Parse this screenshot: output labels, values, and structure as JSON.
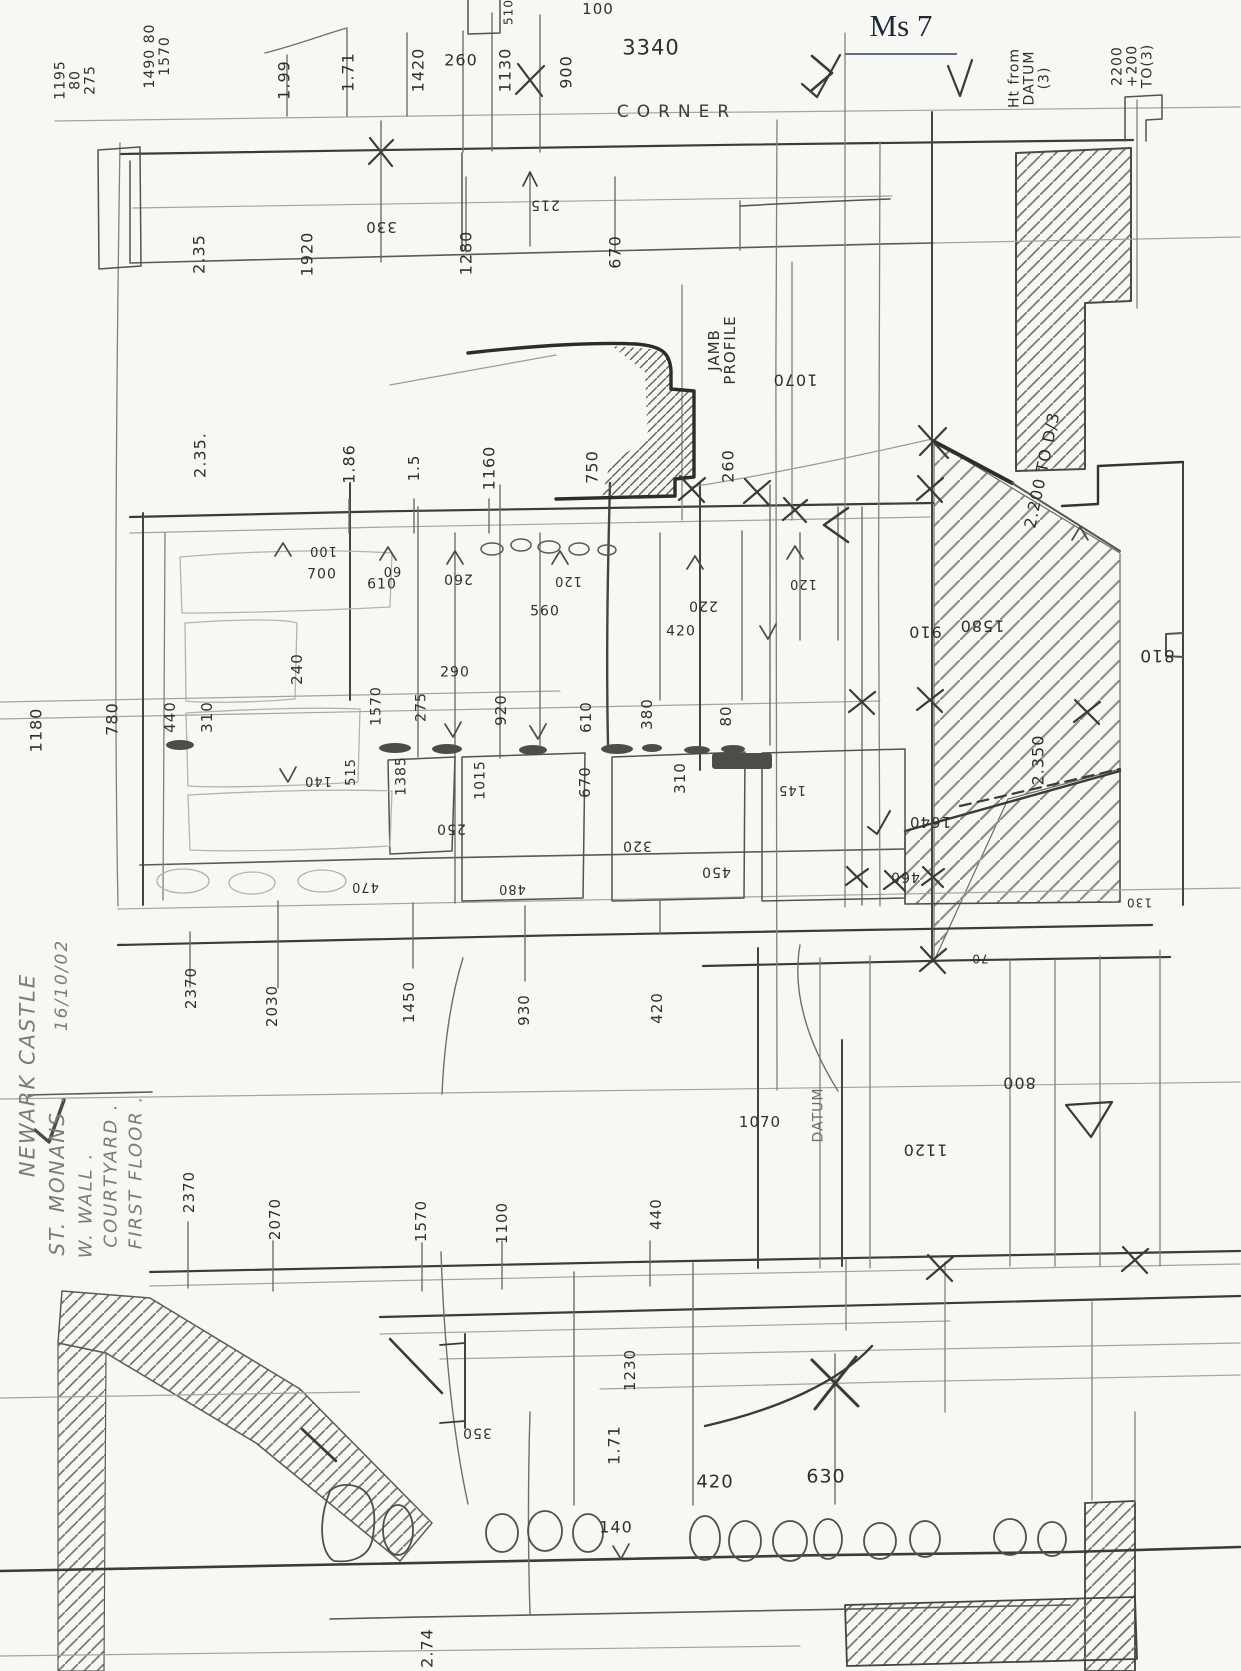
{
  "header": {
    "sheet_label": "Ms 7"
  },
  "palette": {
    "paper": "#f7f7f4",
    "pencil_dark": "#3b3b39",
    "pencil_faint": "#9a9a96",
    "title_ink": "#20293a"
  },
  "annotations": [
    {
      "t": "1195\n80\n275",
      "x": 76,
      "y": 80,
      "r": -90,
      "s": 14
    },
    {
      "t": "1490 80\n1570",
      "x": 158,
      "y": 56,
      "r": -90,
      "s": 14
    },
    {
      "t": "1.99",
      "x": 284,
      "y": 80,
      "r": -90,
      "s": 16
    },
    {
      "t": "1.71",
      "x": 348,
      "y": 72,
      "r": -90,
      "s": 16
    },
    {
      "t": "1420",
      "x": 418,
      "y": 70,
      "r": -90,
      "s": 16
    },
    {
      "t": "260",
      "x": 461,
      "y": 60,
      "r": 0,
      "s": 16
    },
    {
      "t": "1130",
      "x": 505,
      "y": 70,
      "r": -90,
      "s": 16
    },
    {
      "t": "900",
      "x": 566,
      "y": 72,
      "r": -90,
      "s": 16
    },
    {
      "t": "100",
      "x": 598,
      "y": 9,
      "r": 0,
      "s": 15
    },
    {
      "t": "510",
      "x": 509,
      "y": 12,
      "r": -90,
      "s": 12
    },
    {
      "t": "3340",
      "x": 651,
      "y": 48,
      "r": 0,
      "s": 21
    },
    {
      "t": "CORNER",
      "x": 677,
      "y": 112,
      "r": 0,
      "s": 17,
      "c": "spread",
      "n": "corner-label"
    },
    {
      "t": "Ht from\nDATUM\n(3)",
      "x": 1030,
      "y": 78,
      "r": -90,
      "s": 14
    },
    {
      "t": "2200\n+200\nTO(3)",
      "x": 1133,
      "y": 66,
      "r": -90,
      "s": 14
    },
    {
      "t": "2.35",
      "x": 199,
      "y": 254,
      "r": -90,
      "s": 16
    },
    {
      "t": "1920",
      "x": 307,
      "y": 254,
      "r": -90,
      "s": 16
    },
    {
      "t": "330",
      "x": 381,
      "y": 227,
      "r": 180,
      "s": 15
    },
    {
      "t": "215",
      "x": 545,
      "y": 204,
      "r": 180,
      "s": 14
    },
    {
      "t": "1280",
      "x": 466,
      "y": 253,
      "r": -90,
      "s": 16
    },
    {
      "t": "670",
      "x": 615,
      "y": 252,
      "r": -90,
      "s": 16
    },
    {
      "t": "JAMB\nPROFILE",
      "x": 722,
      "y": 350,
      "r": -90,
      "s": 15,
      "n": "jamb-profile-label"
    },
    {
      "t": "1070",
      "x": 795,
      "y": 380,
      "r": 180,
      "s": 16
    },
    {
      "t": "2.35.",
      "x": 200,
      "y": 455,
      "r": -90,
      "s": 16
    },
    {
      "t": "1.86",
      "x": 349,
      "y": 464,
      "r": -90,
      "s": 16
    },
    {
      "t": "1.5",
      "x": 414,
      "y": 468,
      "r": -90,
      "s": 15
    },
    {
      "t": "1160",
      "x": 489,
      "y": 468,
      "r": -90,
      "s": 16
    },
    {
      "t": "750",
      "x": 592,
      "y": 467,
      "r": -90,
      "s": 16
    },
    {
      "t": "260",
      "x": 728,
      "y": 466,
      "r": -90,
      "s": 16
    },
    {
      "t": "2.200 TO D/3",
      "x": 1042,
      "y": 470,
      "r": -78,
      "s": 16
    },
    {
      "t": "100",
      "x": 323,
      "y": 550,
      "r": 180,
      "s": 13
    },
    {
      "t": "700",
      "x": 322,
      "y": 575,
      "r": 0,
      "s": 14
    },
    {
      "t": "60",
      "x": 392,
      "y": 570,
      "r": 180,
      "s": 13
    },
    {
      "t": "610",
      "x": 382,
      "y": 585,
      "r": 0,
      "s": 14
    },
    {
      "t": "260",
      "x": 458,
      "y": 578,
      "r": 180,
      "s": 14
    },
    {
      "t": "120",
      "x": 568,
      "y": 580,
      "r": 180,
      "s": 13
    },
    {
      "t": "560",
      "x": 545,
      "y": 612,
      "r": 0,
      "s": 14
    },
    {
      "t": "220",
      "x": 703,
      "y": 605,
      "r": 180,
      "s": 14
    },
    {
      "t": "120",
      "x": 803,
      "y": 583,
      "r": 180,
      "s": 13
    },
    {
      "t": "420",
      "x": 681,
      "y": 632,
      "r": 0,
      "s": 14
    },
    {
      "t": "910",
      "x": 925,
      "y": 632,
      "r": 180,
      "s": 16
    },
    {
      "t": "1580",
      "x": 982,
      "y": 626,
      "r": 180,
      "s": 16
    },
    {
      "t": "810",
      "x": 1157,
      "y": 655,
      "r": 180,
      "s": 17
    },
    {
      "t": "240",
      "x": 297,
      "y": 669,
      "r": -90,
      "s": 15
    },
    {
      "t": "1180",
      "x": 36,
      "y": 730,
      "r": -90,
      "s": 16
    },
    {
      "t": "780",
      "x": 112,
      "y": 719,
      "r": -90,
      "s": 16
    },
    {
      "t": "440",
      "x": 170,
      "y": 717,
      "r": -90,
      "s": 15
    },
    {
      "t": "310",
      "x": 207,
      "y": 717,
      "r": -90,
      "s": 15
    },
    {
      "t": "140",
      "x": 318,
      "y": 780,
      "r": 180,
      "s": 13
    },
    {
      "t": "515",
      "x": 352,
      "y": 772,
      "r": -90,
      "s": 13
    },
    {
      "t": "1570",
      "x": 377,
      "y": 706,
      "r": -90,
      "s": 14
    },
    {
      "t": "275",
      "x": 422,
      "y": 707,
      "r": -90,
      "s": 14
    },
    {
      "t": "290",
      "x": 455,
      "y": 673,
      "r": 0,
      "s": 14
    },
    {
      "t": "920",
      "x": 501,
      "y": 710,
      "r": -90,
      "s": 15
    },
    {
      "t": "610",
      "x": 586,
      "y": 717,
      "r": -90,
      "s": 15
    },
    {
      "t": "380",
      "x": 647,
      "y": 714,
      "r": -90,
      "s": 15
    },
    {
      "t": "80",
      "x": 726,
      "y": 716,
      "r": -90,
      "s": 15
    },
    {
      "t": "1385",
      "x": 402,
      "y": 776,
      "r": -90,
      "s": 14
    },
    {
      "t": "1015",
      "x": 481,
      "y": 780,
      "r": -90,
      "s": 14
    },
    {
      "t": "670",
      "x": 585,
      "y": 782,
      "r": -90,
      "s": 15
    },
    {
      "t": "310",
      "x": 680,
      "y": 778,
      "r": -90,
      "s": 15
    },
    {
      "t": "145",
      "x": 792,
      "y": 789,
      "r": 180,
      "s": 13
    },
    {
      "t": "250",
      "x": 451,
      "y": 828,
      "r": 180,
      "s": 14
    },
    {
      "t": "320",
      "x": 637,
      "y": 845,
      "r": 180,
      "s": 14
    },
    {
      "t": "450",
      "x": 716,
      "y": 871,
      "r": 180,
      "s": 14
    },
    {
      "t": "470",
      "x": 365,
      "y": 886,
      "r": 180,
      "s": 13
    },
    {
      "t": "480",
      "x": 512,
      "y": 888,
      "r": 180,
      "s": 13
    },
    {
      "t": "460",
      "x": 905,
      "y": 876,
      "r": 180,
      "s": 14
    },
    {
      "t": "1640",
      "x": 930,
      "y": 822,
      "r": 180,
      "s": 15
    },
    {
      "t": "2.350",
      "x": 1038,
      "y": 760,
      "r": -90,
      "s": 16
    },
    {
      "t": "130",
      "x": 1139,
      "y": 902,
      "r": 180,
      "s": 12
    },
    {
      "t": "70",
      "x": 980,
      "y": 958,
      "r": 180,
      "s": 12
    },
    {
      "t": "2370",
      "x": 191,
      "y": 988,
      "r": -90,
      "s": 15
    },
    {
      "t": "2030",
      "x": 272,
      "y": 1006,
      "r": -90,
      "s": 15
    },
    {
      "t": "1450",
      "x": 409,
      "y": 1002,
      "r": -90,
      "s": 15
    },
    {
      "t": "930",
      "x": 524,
      "y": 1010,
      "r": -90,
      "s": 15
    },
    {
      "t": "420",
      "x": 657,
      "y": 1008,
      "r": -90,
      "s": 15
    },
    {
      "t": "1070",
      "x": 760,
      "y": 1122,
      "r": 0,
      "s": 15
    },
    {
      "t": "DATUM",
      "x": 819,
      "y": 1115,
      "r": -90,
      "s": 14,
      "c": "faint",
      "n": "datum-label"
    },
    {
      "t": "800",
      "x": 1019,
      "y": 1083,
      "r": 180,
      "s": 16
    },
    {
      "t": "1120",
      "x": 925,
      "y": 1150,
      "r": 180,
      "s": 16
    },
    {
      "t": "2370",
      "x": 189,
      "y": 1192,
      "r": -90,
      "s": 15
    },
    {
      "t": "2070",
      "x": 275,
      "y": 1219,
      "r": -90,
      "s": 15
    },
    {
      "t": "1570",
      "x": 421,
      "y": 1221,
      "r": -90,
      "s": 15
    },
    {
      "t": "1100",
      "x": 502,
      "y": 1223,
      "r": -90,
      "s": 15
    },
    {
      "t": "440",
      "x": 656,
      "y": 1214,
      "r": -90,
      "s": 15
    },
    {
      "t": "1230",
      "x": 630,
      "y": 1370,
      "r": -90,
      "s": 15
    },
    {
      "t": "350",
      "x": 477,
      "y": 1432,
      "r": 180,
      "s": 14
    },
    {
      "t": "1.71",
      "x": 614,
      "y": 1445,
      "r": -90,
      "s": 16
    },
    {
      "t": "420",
      "x": 715,
      "y": 1482,
      "r": 0,
      "s": 18
    },
    {
      "t": "630",
      "x": 826,
      "y": 1477,
      "r": 0,
      "s": 19
    },
    {
      "t": "140",
      "x": 616,
      "y": 1527,
      "r": 0,
      "s": 16
    },
    {
      "t": "2.74",
      "x": 427,
      "y": 1648,
      "r": -90,
      "s": 16
    },
    {
      "t": "NEWARK CASTLE",
      "x": 28,
      "y": 1075,
      "r": -90,
      "s": 21,
      "c": "pencil",
      "n": "title-line"
    },
    {
      "t": "16/10/02",
      "x": 62,
      "y": 985,
      "r": -90,
      "s": 17,
      "c": "pencil",
      "n": "survey-date"
    },
    {
      "t": "ST. MONANS .",
      "x": 58,
      "y": 1175,
      "r": -90,
      "s": 20,
      "c": "pencil",
      "n": "title-line"
    },
    {
      "t": "W. WALL .",
      "x": 86,
      "y": 1205,
      "r": -90,
      "s": 18,
      "c": "pencil",
      "n": "title-line"
    },
    {
      "t": "COURTYARD .",
      "x": 111,
      "y": 1175,
      "r": -90,
      "s": 18,
      "c": "pencil",
      "n": "title-line"
    },
    {
      "t": "FIRST FLOOR .",
      "x": 136,
      "y": 1172,
      "r": -90,
      "s": 18,
      "c": "pencil",
      "n": "title-line"
    }
  ]
}
